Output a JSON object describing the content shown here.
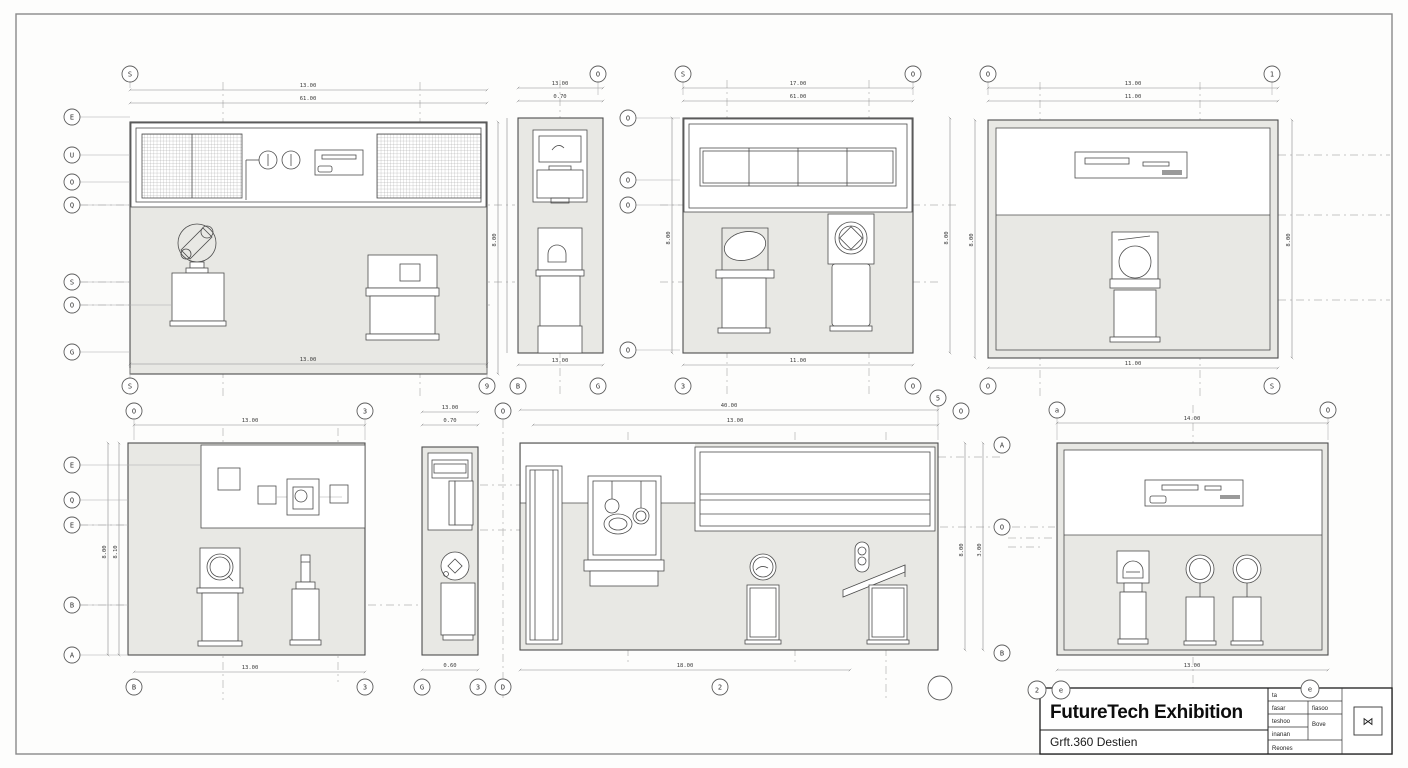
{
  "sheet": {
    "background": "#fdfdfc",
    "border_color": "#8a8a8a",
    "wall_fill": "#e8e8e4",
    "line_color": "#4d4d4d"
  },
  "title_block": {
    "title": "FutureTech Exhibition",
    "subtitle": "Grft.360 Destien",
    "table": {
      "r1c1": "ta",
      "r2c1": "fasar",
      "r2c2": "fiasoo",
      "r3c1": "teshoo",
      "r3c2": "Bove",
      "r4c1": "inanan",
      "r5c1": "Reones"
    },
    "stamp": "⋈"
  },
  "elevations": [
    {
      "name": "north-elevation",
      "dims": {
        "top_a": "13.00",
        "top_b": "61.00",
        "bottom": "13.00",
        "right": "8.00"
      },
      "bubbles": {
        "top": "S",
        "bottom_left": "S",
        "bottom_right": "9",
        "left": [
          "E",
          "U",
          "O",
          "Q",
          "S",
          "O",
          "G"
        ]
      }
    },
    {
      "name": "side-elevation-a",
      "dims": {
        "top_a": "13.00",
        "top_b": "0.70",
        "bottom": "13.00",
        "right": "8.00"
      },
      "bubbles": {
        "top": "O",
        "bottom_left": "B",
        "bottom_right": "G",
        "right": [
          "O",
          "O",
          "O",
          "O"
        ]
      }
    },
    {
      "name": "east-elevation",
      "dims": {
        "top_a": "17.00",
        "top_b": "61.00",
        "bottom": "11.00",
        "right": "8.00"
      },
      "bubbles": {
        "top_left": "S",
        "top_right": "O",
        "bottom_left": "3",
        "bottom_right": "O"
      }
    },
    {
      "name": "west-elevation",
      "dims": {
        "top_a": "13.00",
        "top_b": "11.00",
        "bottom": "11.00",
        "left": "8.00",
        "right": "8.00"
      },
      "bubbles": {
        "top_left": "O",
        "top_right": "1",
        "bottom_left": "O",
        "bottom_right": "S"
      }
    },
    {
      "name": "south-elevation",
      "dims": {
        "top": "13.00",
        "bottom": "13.00",
        "left_a": "8.00",
        "left_b": "8.10"
      },
      "bubbles": {
        "top_left": "O",
        "top_right": "3",
        "bottom_left": "B",
        "bottom_right": "3",
        "left": [
          "E",
          "Q",
          "E",
          "B",
          "A"
        ]
      }
    },
    {
      "name": "side-elevation-b",
      "dims": {
        "top_a": "13.00",
        "top_b": "0.70",
        "bottom": "0.60"
      },
      "bubbles": {
        "top": "O",
        "bottom_left": "G",
        "bottom_mid": "3",
        "bottom_right": "D"
      }
    },
    {
      "name": "long-elevation",
      "dims": {
        "top_a": "40.00",
        "top_b": "13.00",
        "bottom": "18.00",
        "right_a": "8.00",
        "right_b": "3.00"
      },
      "bubbles": {
        "top_a": "5",
        "top_b": "O",
        "bottom": "2",
        "right": [
          "A",
          "O",
          "B"
        ]
      }
    },
    {
      "name": "display-elevation",
      "dims": {
        "top": "14.00",
        "bottom": "13.00"
      },
      "bubbles": {
        "top_left": "a",
        "top_right": "O",
        "title_a": "2",
        "title_b": "e",
        "title_c": "e"
      }
    }
  ]
}
